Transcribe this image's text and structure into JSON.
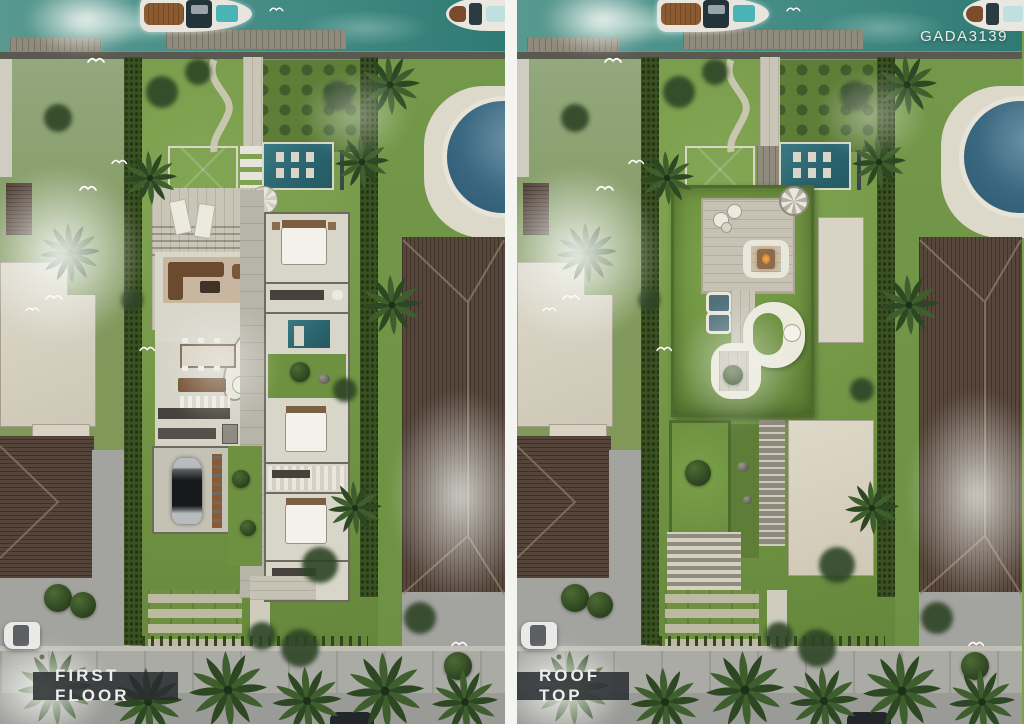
{
  "meta": {
    "watermark": "GADA3139"
  },
  "panels": [
    {
      "id": "first-floor",
      "label": "FIRST FLOOR"
    },
    {
      "id": "roof-top",
      "label": "ROOF TOP"
    }
  ],
  "scene_objects": {
    "boat_main": "wooden-yacht-with-deck-pool",
    "boat_edge": "white-yacht-partial",
    "pools": [
      "reflecting-pool",
      "lounge-pool",
      "plunge-pool",
      "neighbor-round-pool"
    ],
    "vehicles": [
      "white-parked-car",
      "garage-sports-car",
      "dark-parked-car"
    ],
    "rooftop_features": [
      "green-roof",
      "roof-deck",
      "fire-pit-lounge",
      "skylights",
      "spiral-stair",
      "curved-parapet-walk"
    ]
  },
  "colors": {
    "water": "#4a9089",
    "lawn": "#7aa04b",
    "hedge": "#3a5122",
    "pool_teal": "#2b646e",
    "neighbor_pool": "#3a6880",
    "roof_brown": "#57463b",
    "deck_wood": "#c9c5b7",
    "floor": "#dad7cc",
    "green_roof": "#6d9140",
    "road": "#a3a39f",
    "label_bar": "#282c2f",
    "fire_accent": "#d97c35"
  }
}
